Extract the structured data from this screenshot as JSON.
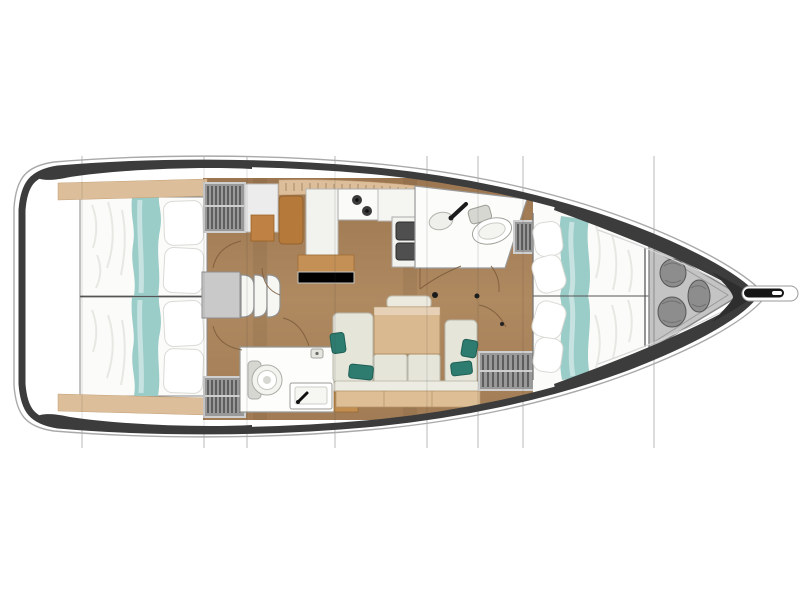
{
  "figure": {
    "type": "sailboat-interior-floor-plan",
    "view": "top-down",
    "orientation": "bow-right",
    "section_lines_x": [
      82,
      204,
      247,
      335,
      427,
      478,
      523,
      654
    ]
  },
  "colors": {
    "background": "#ffffff",
    "hull_band": "#3c3c3c",
    "deck_edge_line": "#a9a9a9",
    "floor_wood": "#a8835f",
    "furniture_wood": "#b5793a",
    "light_table_wood": "#d9b98f",
    "trim_wood": "#dcbe9a",
    "bedding_white": "#fbfbf9",
    "bed_runner_teal": "#9accc8",
    "sofa_cushion": "#e6e5da",
    "sofa_pillow_teal": "#2e7c70",
    "locker_gray": "#999999",
    "locker_slat": "#4a4a4a",
    "fixture_white": "#fdfdfb",
    "sink_dark": "#4f4f4f"
  },
  "areas": [
    {
      "id": "aft-cabin-port",
      "label": "Aft double cabin, port side, with teal bed runner and pillows"
    },
    {
      "id": "aft-cabin-starboard",
      "label": "Aft double cabin, starboard side, with teal bed runner and pillows"
    },
    {
      "id": "aft-head",
      "label": "Aft head compartment with toilet, washbasin and shower control"
    },
    {
      "id": "galley",
      "label": "Galley with two-burner stove, double sink and wooden counters"
    },
    {
      "id": "saloon",
      "label": "Saloon with folding table, stacked chairs, sofa and dining table"
    },
    {
      "id": "forward-head",
      "label": "Forward head with washbasin and toilet"
    },
    {
      "id": "forward-cabin",
      "label": "Forward owner cabin with island double berth"
    },
    {
      "id": "bow-locker",
      "label": "Bow sail locker holding three fender bags"
    },
    {
      "id": "bowsprit",
      "label": "Bowsprit with anchor roller"
    }
  ],
  "fixtures": [
    "stove-burners",
    "double-sink",
    "toilet",
    "washbasin",
    "shower-control",
    "wardrobe-lockers",
    "folding-table",
    "stacked-chairs",
    "sofa",
    "dining-table",
    "fender-bags",
    "bowsprit"
  ]
}
